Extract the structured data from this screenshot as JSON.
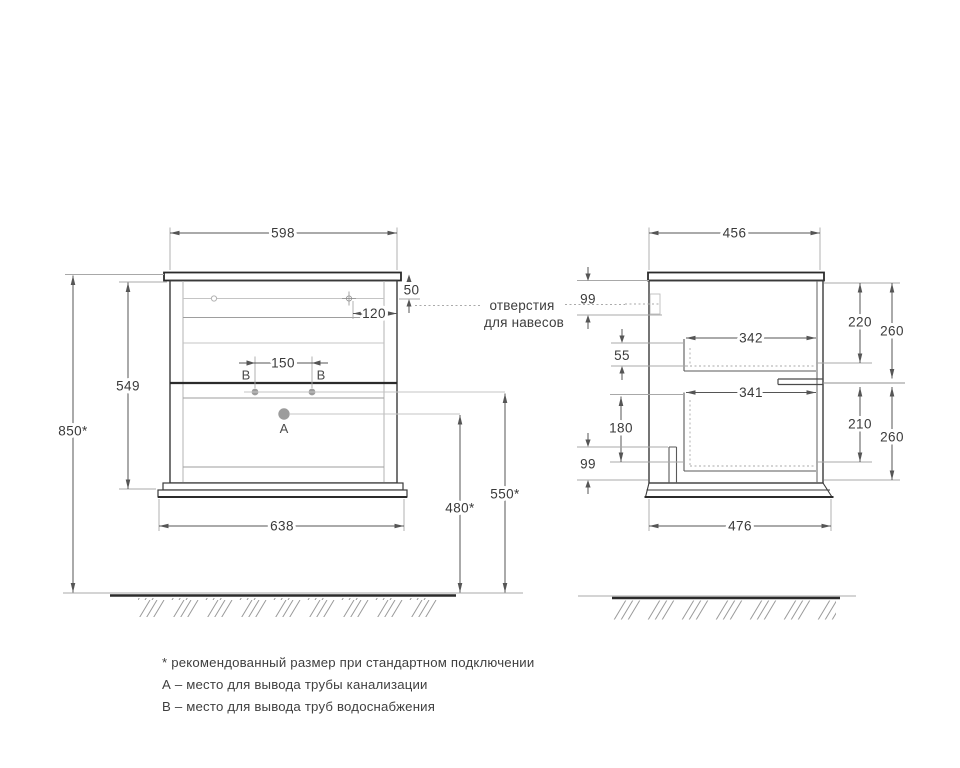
{
  "colors": {
    "background": "#ffffff",
    "line_dark": "#2b2b2b",
    "line_medium": "#555555",
    "line_light": "#a8a8a8",
    "hole_fill": "#9c9c9c",
    "text": "#3a3a3a"
  },
  "front_view": {
    "dims": {
      "top_width": "598",
      "worktop_to_holes": "50",
      "hole_inset": "120",
      "b_holes_spacing": "150",
      "cabinet_height": "549",
      "total_height": "850*",
      "base_width": "638",
      "a_outlet_height": "480*",
      "b_outlet_height": "550*"
    },
    "labels": {
      "a": "A",
      "b_left": "B",
      "b_right": "B"
    }
  },
  "side_view": {
    "dims": {
      "top_depth": "456",
      "hanger_hole_offset": "99",
      "upper_drawer_top_offset": "55",
      "upper_drawer_depth": "342",
      "upper_drawer_inner_height": "220",
      "upper_section_height": "260",
      "lower_drawer_depth": "341",
      "lower_drawer_inner_height": "210",
      "lower_section_height": "260",
      "outlet_offset": "180",
      "bottom_offset": "99",
      "base_depth": "476"
    }
  },
  "callout": {
    "line1": "отверстия",
    "line2": "для навесов"
  },
  "legend": {
    "note_asterisk": "* рекомендованный размер при стандартном подключении",
    "note_a": "А – место для вывода трубы канализации",
    "note_b": "В – место для вывода труб водоснабжения"
  }
}
